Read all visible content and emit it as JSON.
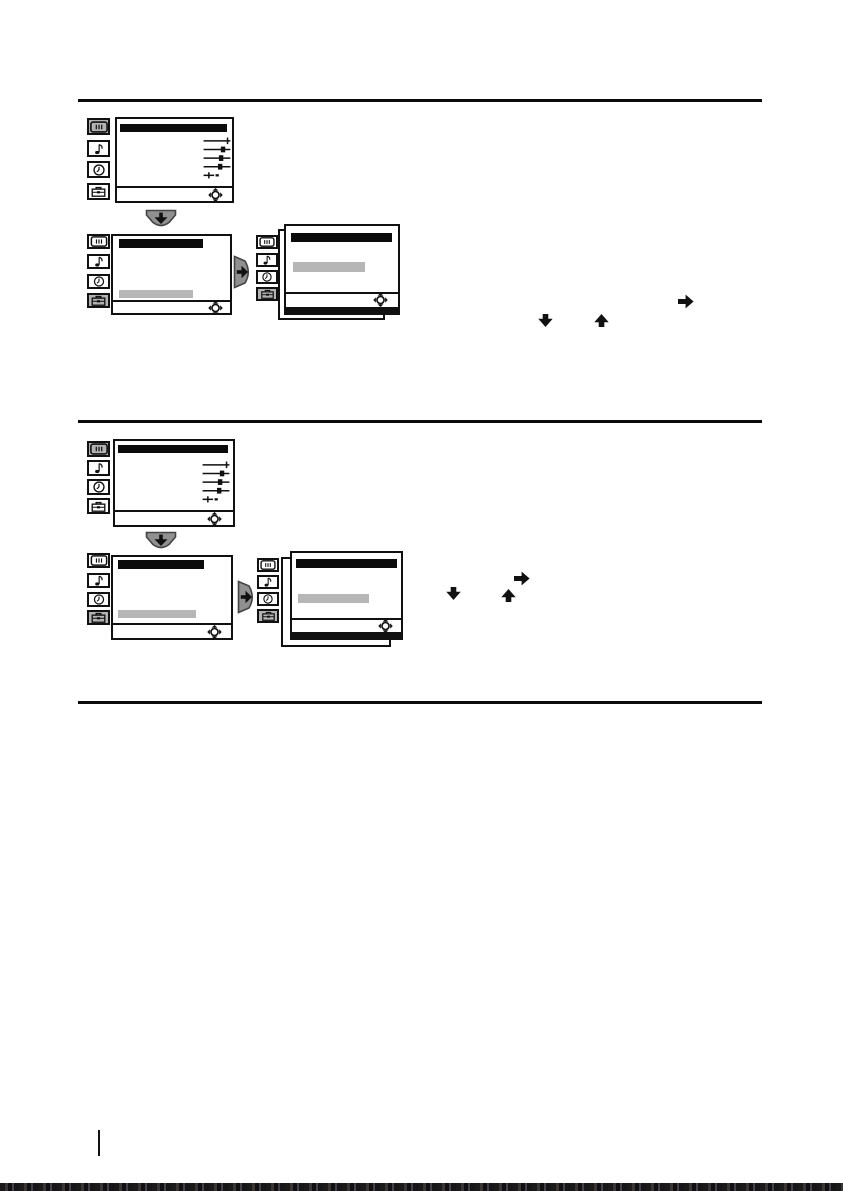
{
  "document": {
    "type": "scanned-manual-page",
    "background": "#ffffff"
  },
  "palette": {
    "ink": "#111111",
    "title_bar": "#0b0b0b",
    "highlight_row": "#b6b6b6",
    "active_icon_background": "#b3b3b3",
    "nav_button_fill": "#909090",
    "nav_button_border": "#444444",
    "divider": "#0b0b0b",
    "page_bg": "#ffffff"
  },
  "sidebar_icons": [
    "picture",
    "music-note",
    "clock",
    "toolbox"
  ],
  "sections": [
    {
      "name": "procedure-1",
      "menu_flow": {
        "screens": [
          {
            "name": "main-menu",
            "active_icon": "picture",
            "content": [
              "title-bar",
              "adjustment-sliders",
              "joystick-nav"
            ]
          },
          {
            "name": "setup-menu",
            "active_icon": "toolbox",
            "content": [
              "title-bar",
              "highlighted-row",
              "joystick-nav"
            ]
          },
          {
            "name": "setup-submenu",
            "active_icon": "toolbox",
            "stacked_panels": 2,
            "content": [
              "title-bar",
              "highlighted-row",
              "joystick-nav"
            ]
          }
        ],
        "transitions": [
          "down-button",
          "right-button"
        ]
      },
      "inline_arrow_glyphs": [
        "right",
        "down",
        "up"
      ]
    },
    {
      "name": "procedure-2",
      "menu_flow": {
        "screens": [
          {
            "name": "main-menu",
            "active_icon": "picture",
            "content": [
              "title-bar",
              "adjustment-sliders",
              "joystick-nav"
            ]
          },
          {
            "name": "setup-menu",
            "active_icon": "toolbox",
            "content": [
              "title-bar",
              "highlighted-row",
              "joystick-nav"
            ]
          },
          {
            "name": "setup-submenu",
            "active_icon": "toolbox",
            "stacked_panels": 2,
            "content": [
              "title-bar",
              "highlighted-row",
              "joystick-nav"
            ]
          }
        ],
        "transitions": [
          "down-button",
          "right-button"
        ]
      },
      "inline_arrow_glyphs": [
        "down",
        "up",
        "right"
      ]
    }
  ],
  "footer": {
    "page_number_divider": true,
    "bottom_scan_band": true
  }
}
